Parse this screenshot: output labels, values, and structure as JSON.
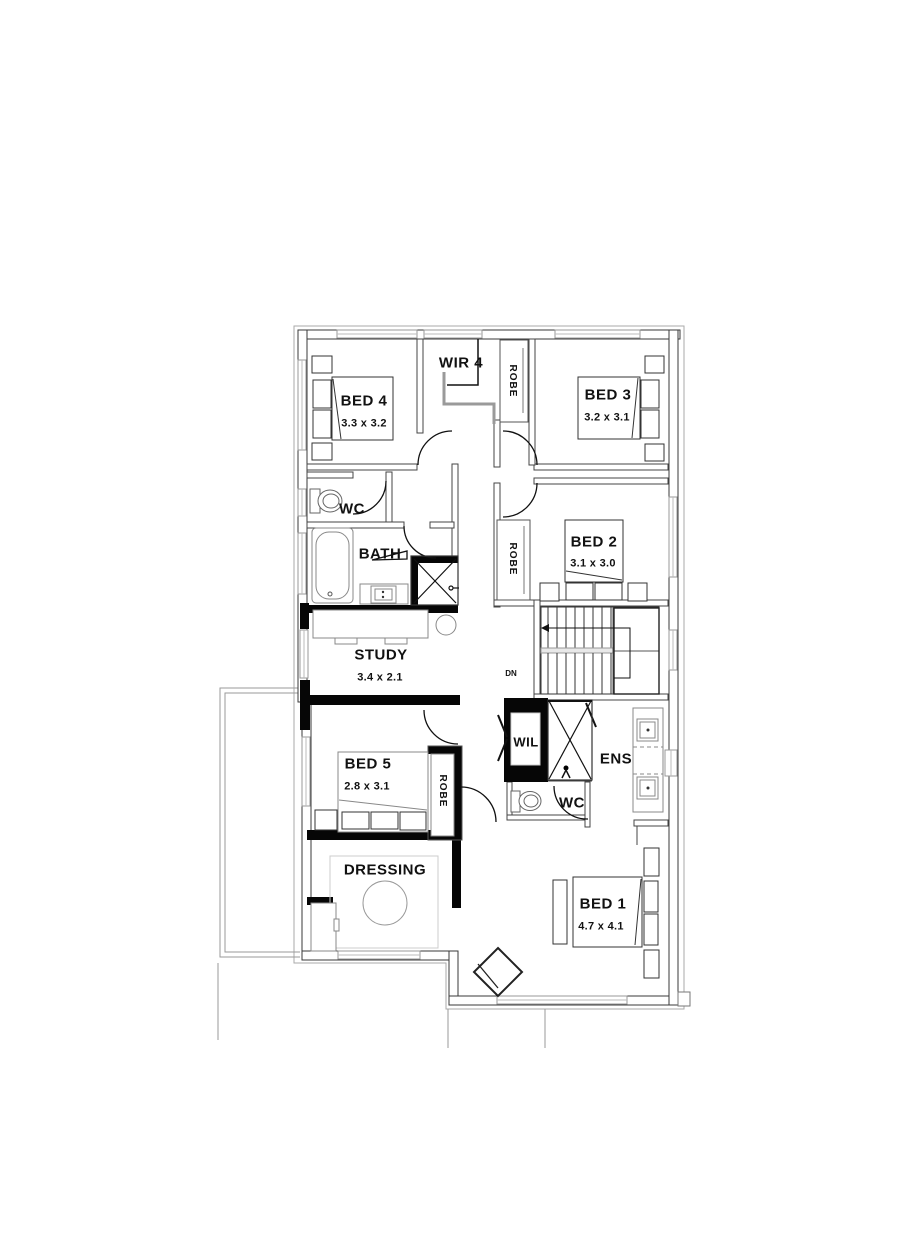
{
  "plan": {
    "bed4": {
      "name": "BED 4",
      "dims": "3.3 x 3.2"
    },
    "wir4": {
      "name": "WIR 4"
    },
    "robe_top": {
      "name": "ROBE"
    },
    "bed3": {
      "name": "BED 3",
      "dims": "3.2 x 3.1"
    },
    "wc_upper": {
      "name": "WC"
    },
    "bath": {
      "name": "BATH"
    },
    "bed2": {
      "name": "BED 2",
      "dims": "3.1 x 3.0"
    },
    "robe_bed2": {
      "name": "ROBE"
    },
    "study": {
      "name": "STUDY",
      "dims": "3.4 x 2.1"
    },
    "stairs": {
      "direction": "DN"
    },
    "wil": {
      "name": "WIL"
    },
    "ens": {
      "name": "ENS"
    },
    "wc_ens": {
      "name": "WC"
    },
    "bed5": {
      "name": "BED 5",
      "dims": "2.8 x 3.1"
    },
    "robe_bed5": {
      "name": "ROBE"
    },
    "dressing": {
      "name": "DRESSING"
    },
    "bed1": {
      "name": "BED 1",
      "dims": "4.7 x 4.1"
    }
  },
  "colors": {
    "wall_line": "#3a3a3a",
    "wall_black": "#060606",
    "light_line": "#9a9a9a",
    "text": "#111111",
    "background": "#ffffff"
  }
}
